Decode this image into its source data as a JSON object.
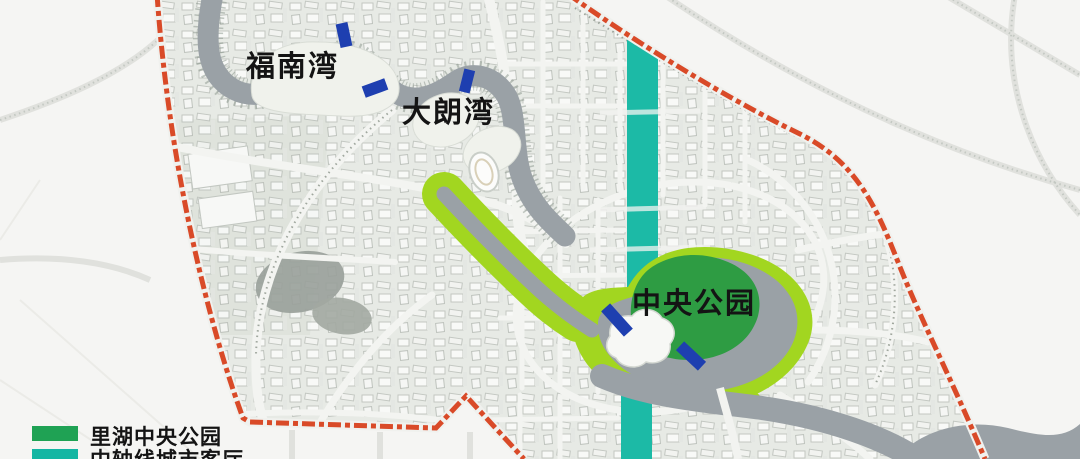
{
  "map_labels": {
    "funan_bay": "福南湾",
    "dalang_bay": "大朗湾",
    "central_park": "中央公园"
  },
  "legend": {
    "items": [
      {
        "label": "里湖中央公园",
        "color": "#1fa254"
      },
      {
        "label": "中轴线城市客厅",
        "color": "#14b6a3"
      }
    ]
  },
  "colors": {
    "park_green": "#2e9c43",
    "greenway": "#a2d620",
    "axis_teal": "#1cbaa6",
    "boundary_red": "#d94a28",
    "bridge_blue": "#1e3fb0",
    "water": "#9aa1a6",
    "label_text": "#141414"
  }
}
